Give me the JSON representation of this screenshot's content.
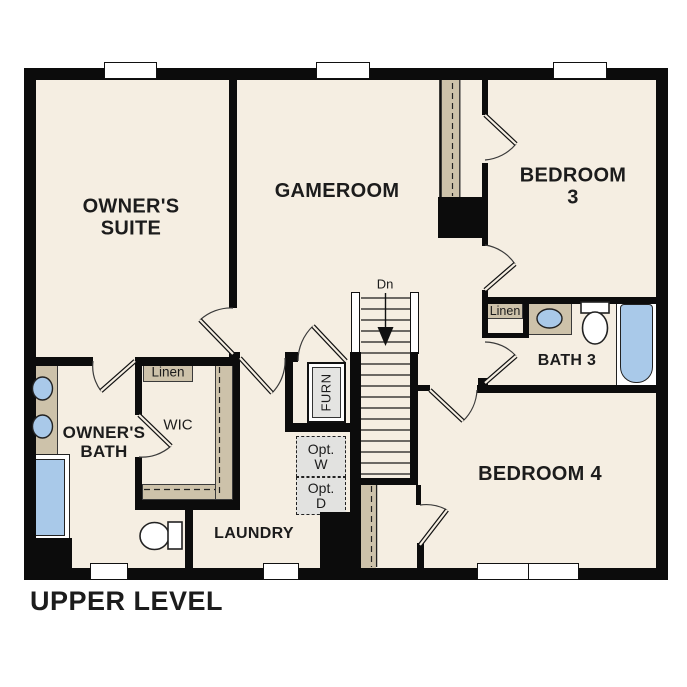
{
  "title": "UPPER LEVEL",
  "rooms": {
    "owners_suite": "OWNER'S\nSUITE",
    "gameroom": "GAMEROOM",
    "bedroom3": "BEDROOM 3",
    "bath3": "BATH 3",
    "bedroom4": "BEDROOM 4",
    "owners_bath": "OWNER'S\nBATH",
    "wic": "WIC",
    "laundry": "LAUNDRY"
  },
  "features": {
    "stairs_direction": "Dn",
    "furnace": "FURN",
    "optional_washer": "Opt.\nW",
    "optional_dryer": "Opt.\nD",
    "linen_owners": "Linen",
    "linen_bath3": "Linen"
  },
  "colors": {
    "floor": "#f5eee2",
    "wall": "#0c0c0c",
    "casework": "#cdc2aa",
    "fixture_blue": "#a9c9e9",
    "optional_fill": "#e2e2e0"
  }
}
